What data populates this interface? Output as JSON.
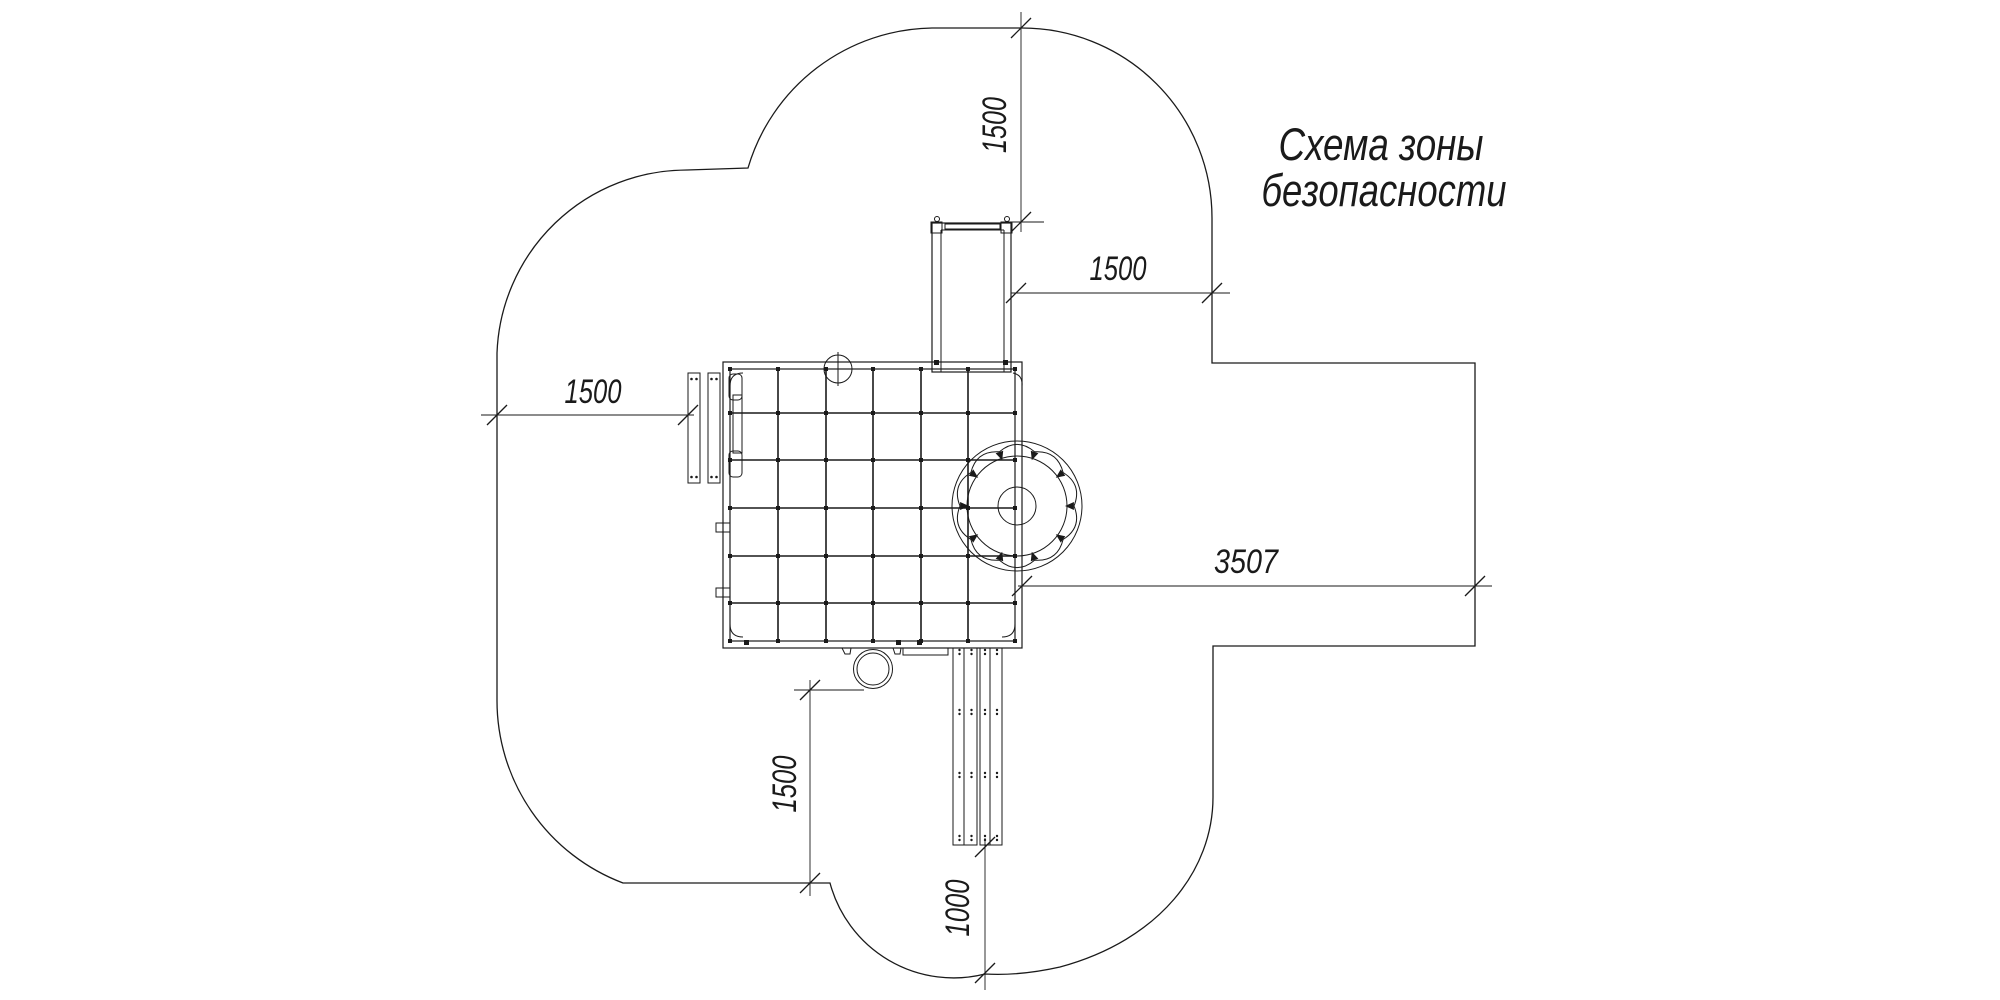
{
  "title": {
    "line1": "Схема зоны",
    "line2": "безопасности"
  },
  "dimensions": {
    "top_offset": "1500",
    "tower_to_boundary": "1500",
    "bench_to_boundary": "1500",
    "slide_zone_width": "3507",
    "drum_to_boundary": "1500",
    "ramp_to_boundary": "1000"
  },
  "colors": {
    "ink": "#1a1a1a",
    "paper": "#ffffff"
  }
}
